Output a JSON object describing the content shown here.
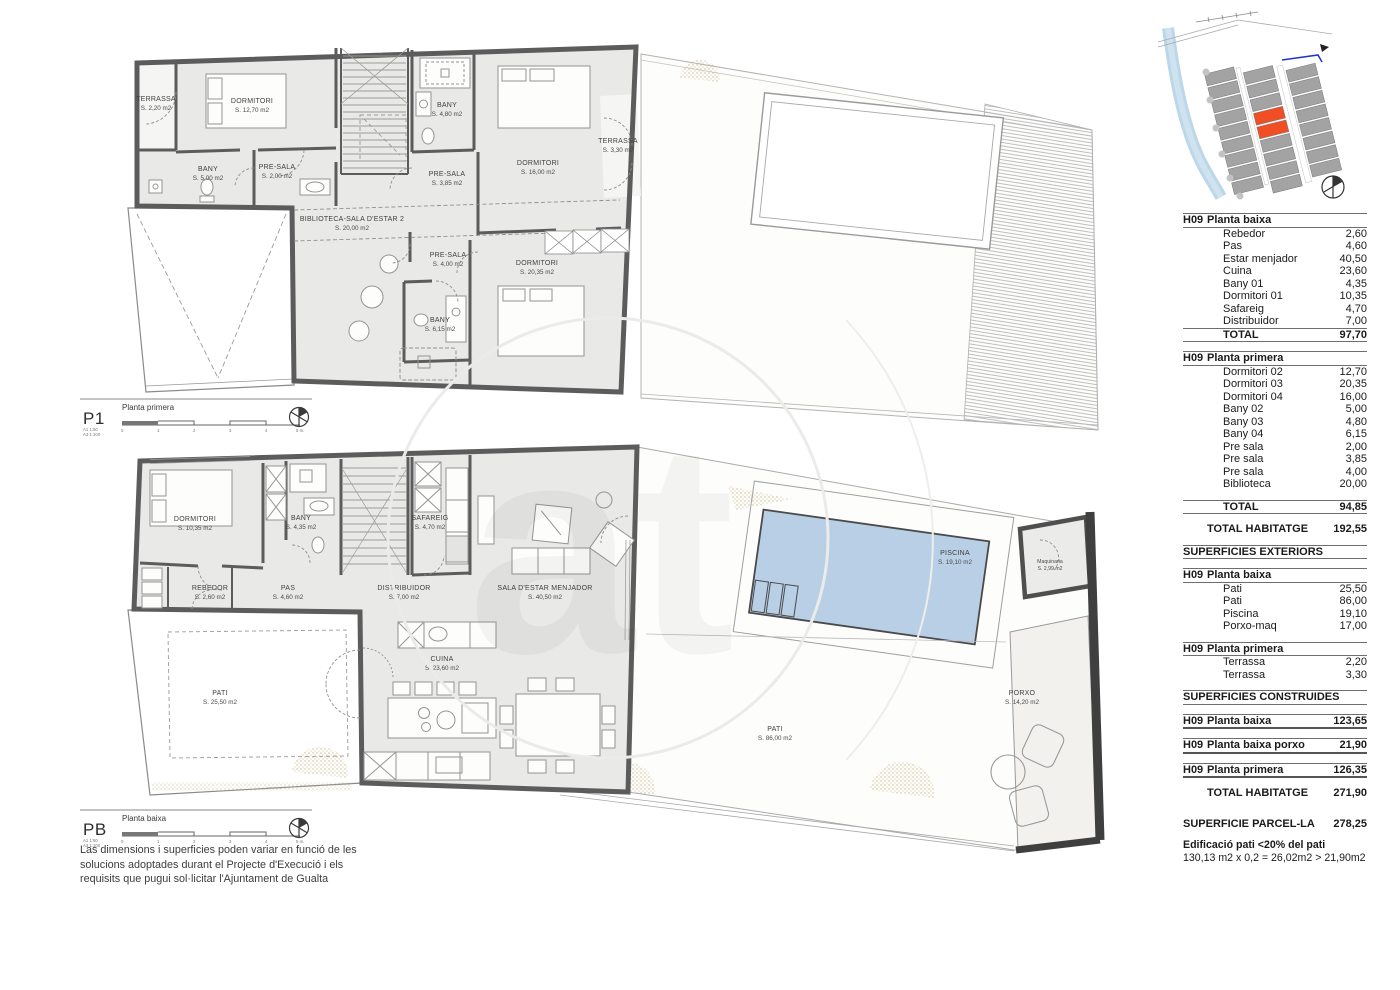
{
  "p1": {
    "code": "P1",
    "title": "Planta primera",
    "scale_a1": "A1  1:50",
    "scale_a3": "A3  1:100",
    "rooms": [
      {
        "name": "TERRASSA",
        "area": "S. 2,20 m2"
      },
      {
        "name": "DORMITORI",
        "area": "S. 12,70 m2"
      },
      {
        "name": "BANY",
        "area": "S. 5,00 m2"
      },
      {
        "name": "PRE-SALA",
        "area": "S. 2,00 m2"
      },
      {
        "name": "BIBLIOTECA-SALA D'ESTAR 2",
        "area": "S. 20,00 m2"
      },
      {
        "name": "BANY",
        "area": "S. 4,80 m2"
      },
      {
        "name": "PRE-SALA",
        "area": "S. 3,85 m2"
      },
      {
        "name": "DORMITORI",
        "area": "S. 16,00 m2"
      },
      {
        "name": "TERRASSA",
        "area": "S. 3,30 m2"
      },
      {
        "name": "PRE-SALA",
        "area": "S. 4,00 m2"
      },
      {
        "name": "BANY",
        "area": "S. 6,15 m2"
      },
      {
        "name": "DORMITORI",
        "area": "S. 20,35 m2"
      }
    ]
  },
  "pb": {
    "code": "PB",
    "title": "Planta baixa",
    "scale_a1": "A1  1:50",
    "scale_a3": "A3  1:100",
    "rooms": [
      {
        "name": "DORMITORI",
        "area": "S. 10,35 m2"
      },
      {
        "name": "BANY",
        "area": "S. 4,35 m2"
      },
      {
        "name": "SAFAREIG",
        "area": "S. 4,70 m2"
      },
      {
        "name": "REBEDOR",
        "area": "S. 2,60 m2"
      },
      {
        "name": "PAS",
        "area": "S. 4,60 m2"
      },
      {
        "name": "DISTRIBUIDOR",
        "area": "S. 7,00 m2"
      },
      {
        "name": "SALA D'ESTAR MENJADOR",
        "area": "S. 40,50 m2"
      },
      {
        "name": "CUINA",
        "area": "S. 23,60 m2"
      },
      {
        "name": "PATI",
        "area": "S. 25,50 m2"
      },
      {
        "name": "PISCINA",
        "area": "S. 19,10 m2"
      },
      {
        "name": "Maquinaria",
        "area": "S. 2,99 m2"
      },
      {
        "name": "PATI",
        "area": "S. 86,00 m2"
      },
      {
        "name": "PORXO",
        "area": "S. 14,20 m2"
      }
    ]
  },
  "scale_ticks": [
    "0",
    "1",
    "2",
    "3",
    "4",
    "5 m."
  ],
  "disclaimer": [
    "Las dimensions i superficies poden variar en funció de les",
    "solucions adoptades durant el Projecte d'Execució i els",
    "requisits que pugui sol·licitar l'Ajuntament de Gualta"
  ],
  "table": {
    "rows": [
      {
        "t": "h",
        "a": "H09",
        "b": "Planta baixa",
        "v": ""
      },
      {
        "t": "it",
        "b": "Rebedor",
        "v": "2,60"
      },
      {
        "t": "it",
        "b": "Pas",
        "v": "4,60"
      },
      {
        "t": "it",
        "b": "Estar menjador",
        "v": "40,50"
      },
      {
        "t": "it",
        "b": "Cuina",
        "v": "23,60"
      },
      {
        "t": "it",
        "b": "Bany 01",
        "v": "4,35"
      },
      {
        "t": "it",
        "b": "Dormitori 01",
        "v": "10,35"
      },
      {
        "t": "it",
        "b": "Safareig",
        "v": "4,70"
      },
      {
        "t": "it",
        "b": "Distribuidor",
        "v": "7,00"
      },
      {
        "t": "tot",
        "b": "TOTAL",
        "v": "97,70"
      },
      {
        "t": "gap"
      },
      {
        "t": "h",
        "a": "H09",
        "b": "Planta primera",
        "v": ""
      },
      {
        "t": "it",
        "b": "Dormitori 02",
        "v": "12,70"
      },
      {
        "t": "it",
        "b": "Dormitori 03",
        "v": "20,35"
      },
      {
        "t": "it",
        "b": "Dormitori 04",
        "v": "16,00"
      },
      {
        "t": "it",
        "b": "Bany 02",
        "v": "5,00"
      },
      {
        "t": "it",
        "b": "Bany 03",
        "v": "4,80"
      },
      {
        "t": "it",
        "b": "Bany 04",
        "v": "6,15"
      },
      {
        "t": "it",
        "b": "Pre sala",
        "v": "2,00"
      },
      {
        "t": "it",
        "b": "Pre sala",
        "v": "3,85"
      },
      {
        "t": "it",
        "b": "Pre sala",
        "v": "4,00"
      },
      {
        "t": "it",
        "b": "Biblioteca",
        "v": "20,00"
      },
      {
        "t": "gap"
      },
      {
        "t": "tot",
        "b": "TOTAL",
        "v": "94,85"
      },
      {
        "t": "gap"
      },
      {
        "t": "tb",
        "b": "TOTAL HABITATGE",
        "v": "192,55"
      },
      {
        "t": "gap"
      },
      {
        "t": "sec",
        "b": "SUPERFICIES EXTERIORS",
        "v": ""
      },
      {
        "t": "gap"
      },
      {
        "t": "h",
        "a": "H09",
        "b": "Planta baixa",
        "v": ""
      },
      {
        "t": "it",
        "b": "Pati",
        "v": "25,50"
      },
      {
        "t": "it",
        "b": "Pati",
        "v": "86,00"
      },
      {
        "t": "it",
        "b": "Piscina",
        "v": "19,10"
      },
      {
        "t": "it",
        "b": "Porxo-maq",
        "v": "17,00"
      },
      {
        "t": "gap"
      },
      {
        "t": "h",
        "a": "H09",
        "b": "Planta primera",
        "v": ""
      },
      {
        "t": "it",
        "b": "Terrassa",
        "v": "2,20"
      },
      {
        "t": "it",
        "b": "Terrassa",
        "v": "3,30"
      },
      {
        "t": "gap"
      },
      {
        "t": "sec",
        "b": "SUPERFICIES CONSTRUIDES",
        "v": ""
      },
      {
        "t": "gap"
      },
      {
        "t": "hv",
        "a": "H09",
        "b": "Planta baixa",
        "v": "123,65"
      },
      {
        "t": "gap"
      },
      {
        "t": "hv",
        "a": "H09",
        "b": "Planta baixa porxo",
        "v": "21,90"
      },
      {
        "t": "gap"
      },
      {
        "t": "hv",
        "a": "H09",
        "b": "Planta primera",
        "v": "126,35"
      },
      {
        "t": "gap"
      },
      {
        "t": "tb",
        "b": "TOTAL HABITATGE",
        "v": "271,90"
      },
      {
        "t": "gap"
      },
      {
        "t": "gap"
      },
      {
        "t": "par",
        "b": "SUPERFICIE PARCEL-LA",
        "v": "278,25"
      },
      {
        "t": "gap"
      },
      {
        "t": "noteb",
        "b": "Edificació pati <20% del pati",
        "v": ""
      },
      {
        "t": "note",
        "b": "130,13 m2 x 0,2 = 26,02m2 > 21,90m2",
        "v": ""
      }
    ]
  },
  "colors": {
    "wall": "#5c5c5c",
    "room_fill": "#e9e9e7",
    "pool": "#b9cfe5",
    "unit_highlight": "#f04e24",
    "river": "#b5d3e6"
  }
}
